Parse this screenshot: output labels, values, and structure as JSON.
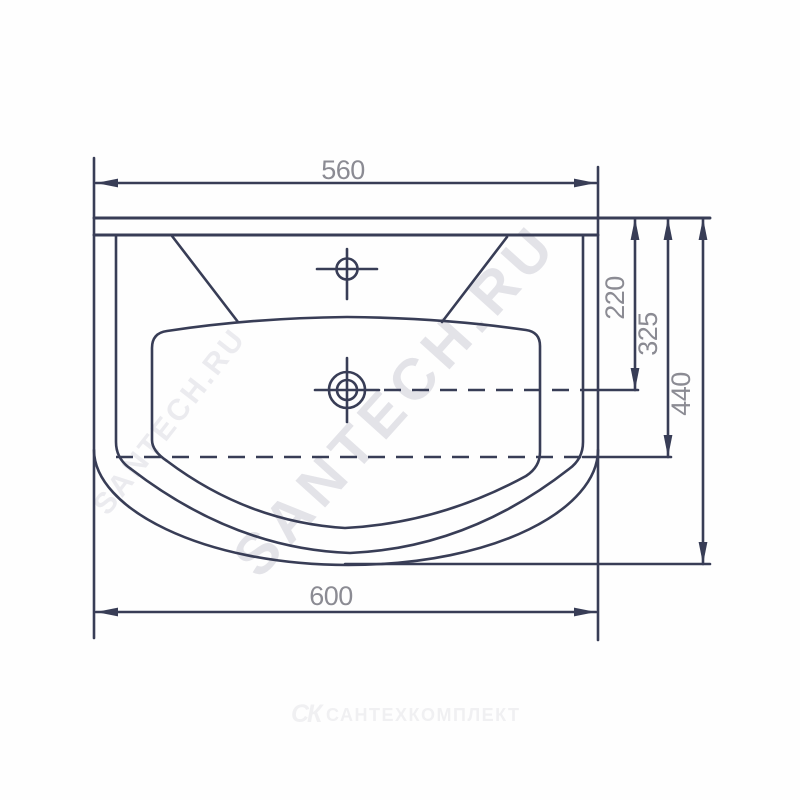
{
  "drawing": {
    "type": "washbasin plan view technical drawing",
    "dims": {
      "top_width": "560",
      "overall_width": "600",
      "drain_offset": "220",
      "inner_depth": "325",
      "overall_depth": "440"
    },
    "symbols": {
      "faucet_hole": "crosshair-small",
      "drain_hole": "crosshair-double-circle"
    },
    "watermarks": {
      "main": "SANTECH.RU",
      "secondary": "SANTECH.RU"
    },
    "footer": {
      "logo_mark": "СК",
      "brand": "САНТЕХКОМПЛЕКТ"
    },
    "colors": {
      "line": "#383d56",
      "dim_text": "#8b8b93",
      "watermark": "#e3e3e8",
      "logo": "#f0f0f2",
      "background": "#ffffff"
    }
  }
}
